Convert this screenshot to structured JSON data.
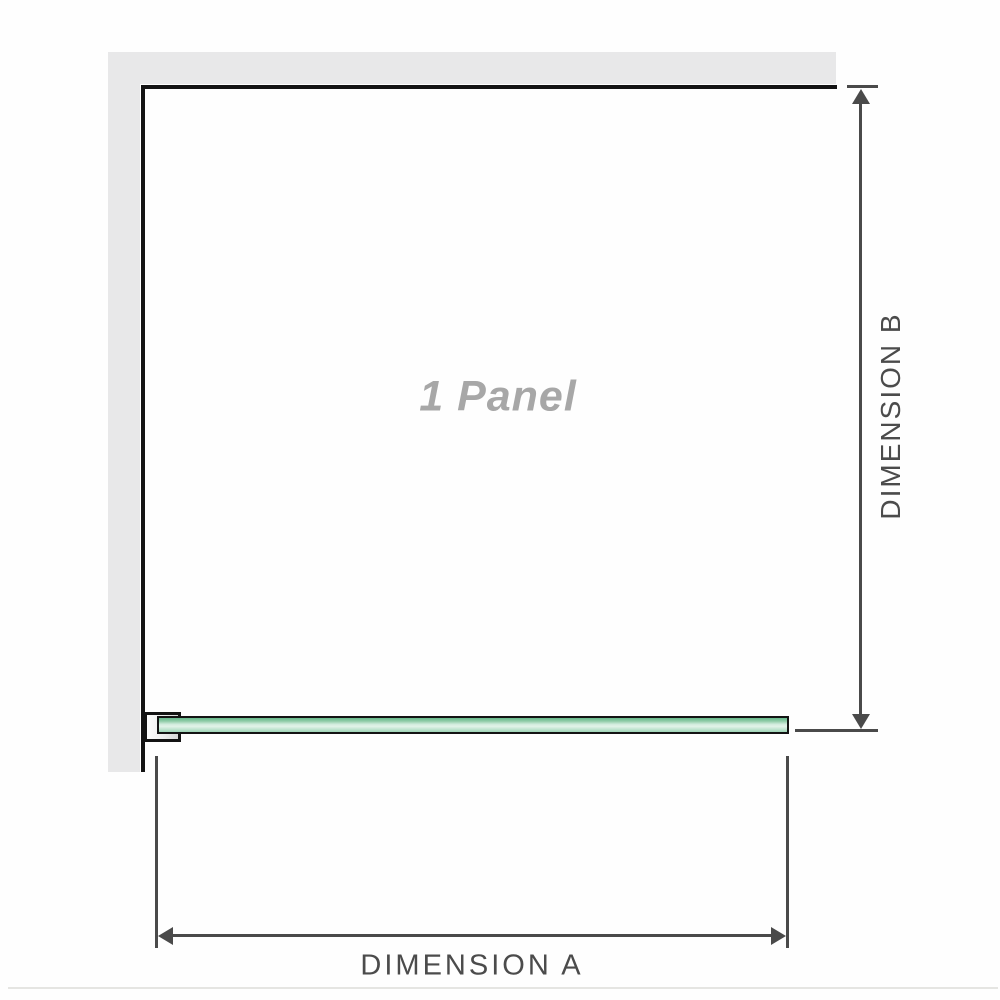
{
  "diagram": {
    "panel_label": "1 Panel",
    "dimension_a": {
      "label": "DIMENSION A",
      "orientation": "horizontal"
    },
    "dimension_b": {
      "label": "DIMENSION B",
      "orientation": "vertical"
    },
    "colors": {
      "background": "#fefefe",
      "wall_fill": "#e8e8e9",
      "outline": "#131313",
      "dimension_line": "#4a4a4a",
      "dimension_text": "#4b4b4b",
      "panel_label_text": "#a7a7a7",
      "glass_green_dark": "#66b98b",
      "glass_green_light": "#e3f3e9",
      "glass_green_bottom": "#9ed4b6",
      "baseline_rule": "#e5e5e2"
    }
  }
}
